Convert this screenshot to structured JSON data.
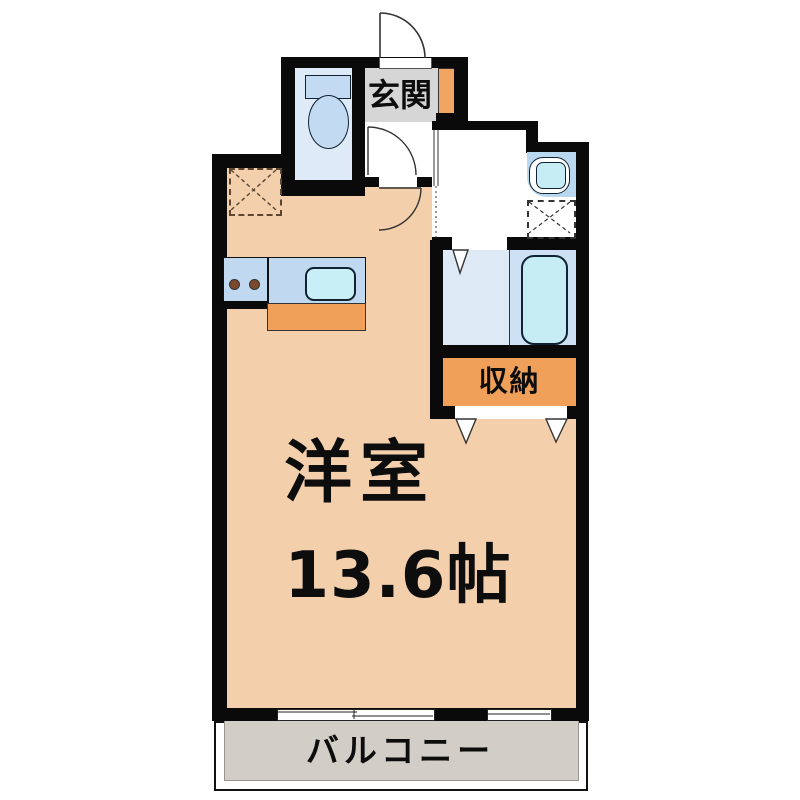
{
  "floorplan": {
    "entrance_label": "玄関",
    "storage_label": "収納",
    "main_room_label": "洋室",
    "main_room_size": "13.6帖",
    "balcony_label": "バルコニー"
  },
  "colors": {
    "wall": "#0a0a0a",
    "main_room_floor": "#F3CFAB",
    "toilet_floor": "#DEEAF8",
    "bathroom_floor_left": "#DEE9F6",
    "bathroom_floor_right": "#CDE0F4",
    "fixture_cyan": "#C6ECF4",
    "fixture_blue": "#C2DAF2",
    "accent_orange": "#F0A058",
    "entrance_floor": "#D6D6D6",
    "balcony_floor": "#D3CDC7",
    "kitchen_counter": "#C0D9F1",
    "burner_brown": "#7B4A2D"
  }
}
